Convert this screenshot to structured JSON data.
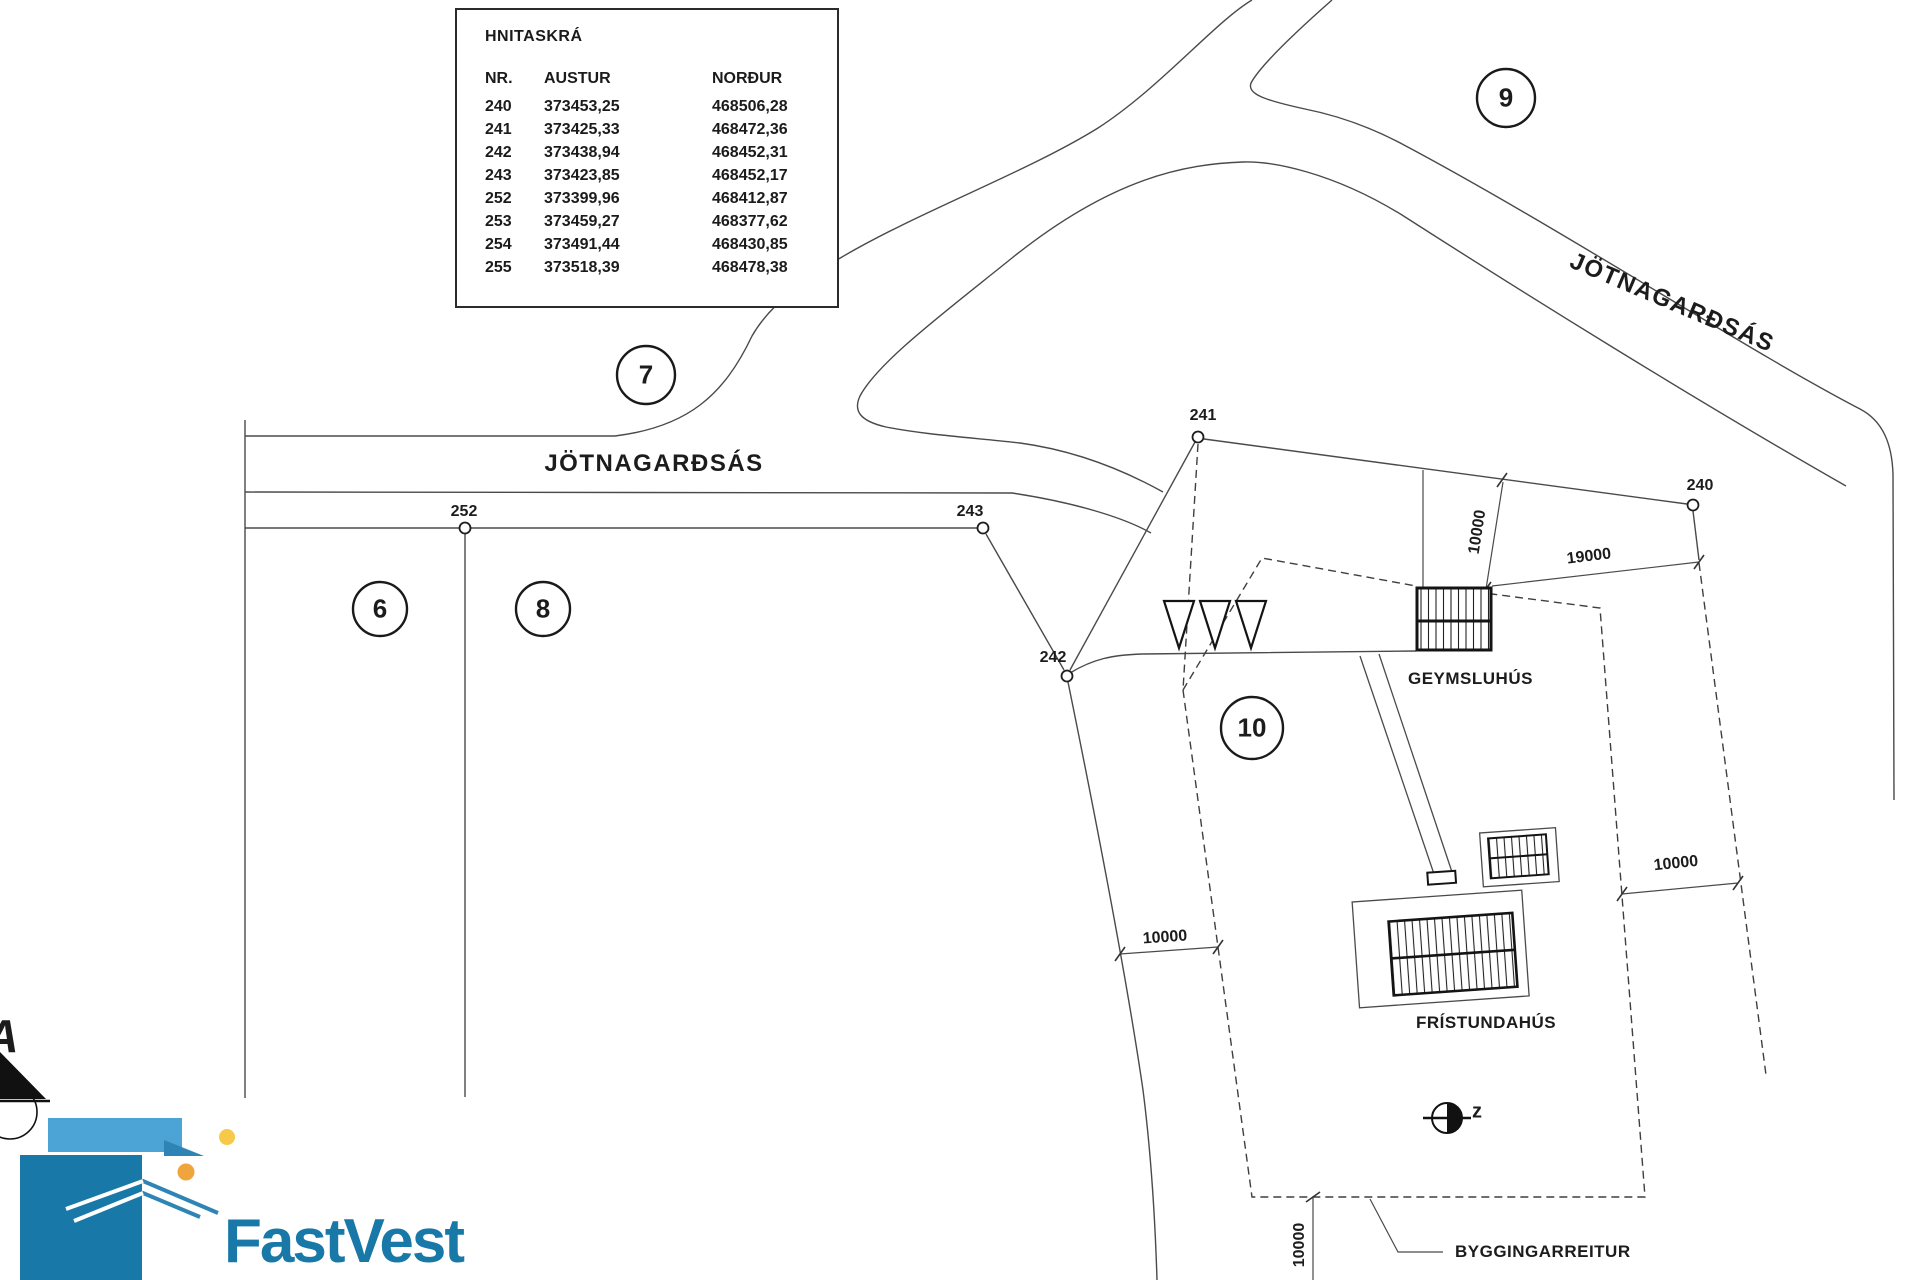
{
  "theme": {
    "line": "#4a4a4a",
    "dark_line": "#161616",
    "logo_dark": "#1878A8",
    "logo_mid": "#2E85B5",
    "logo_light": "#4BA3D6",
    "logo_orange": "#F0A43C",
    "logo_yellow": "#F7C948"
  },
  "coord_table": {
    "title": "HNITASKRÁ",
    "columns": [
      "NR.",
      "AUSTUR",
      "NORÐUR"
    ],
    "rows": [
      [
        "240",
        "373453,25",
        "468506,28"
      ],
      [
        "241",
        "373425,33",
        "468472,36"
      ],
      [
        "242",
        "373438,94",
        "468452,31"
      ],
      [
        "243",
        "373423,85",
        "468452,17"
      ],
      [
        "252",
        "373399,96",
        "468412,87"
      ],
      [
        "253",
        "373459,27",
        "468377,62"
      ],
      [
        "254",
        "373491,44",
        "468430,85"
      ],
      [
        "255",
        "373518,39",
        "468478,38"
      ]
    ]
  },
  "roads": {
    "west_label": "JÖTNAGARÐSÁS",
    "northeast_label": "JÖTNAGARÐSÁS"
  },
  "plots": {
    "p6": "6",
    "p7": "7",
    "p8": "8",
    "p9": "9",
    "p10": "10"
  },
  "points": {
    "p240": "240",
    "p241": "241",
    "p242": "242",
    "p243": "243",
    "p252": "252"
  },
  "buildings": {
    "shed": "GEYMSLUHÚS",
    "cabin": "FRÍSTUNDAHÚS",
    "envelope": "BYGGINGARREITUR"
  },
  "dimensions": {
    "plot_width": "19000",
    "north_offset": "10000",
    "east_offset": "10000",
    "west_offset": "10000",
    "south_offset": "10000"
  },
  "symbols": {
    "north_letter": "z",
    "compass_letter": "A"
  },
  "logo": {
    "name": "FastVest"
  }
}
